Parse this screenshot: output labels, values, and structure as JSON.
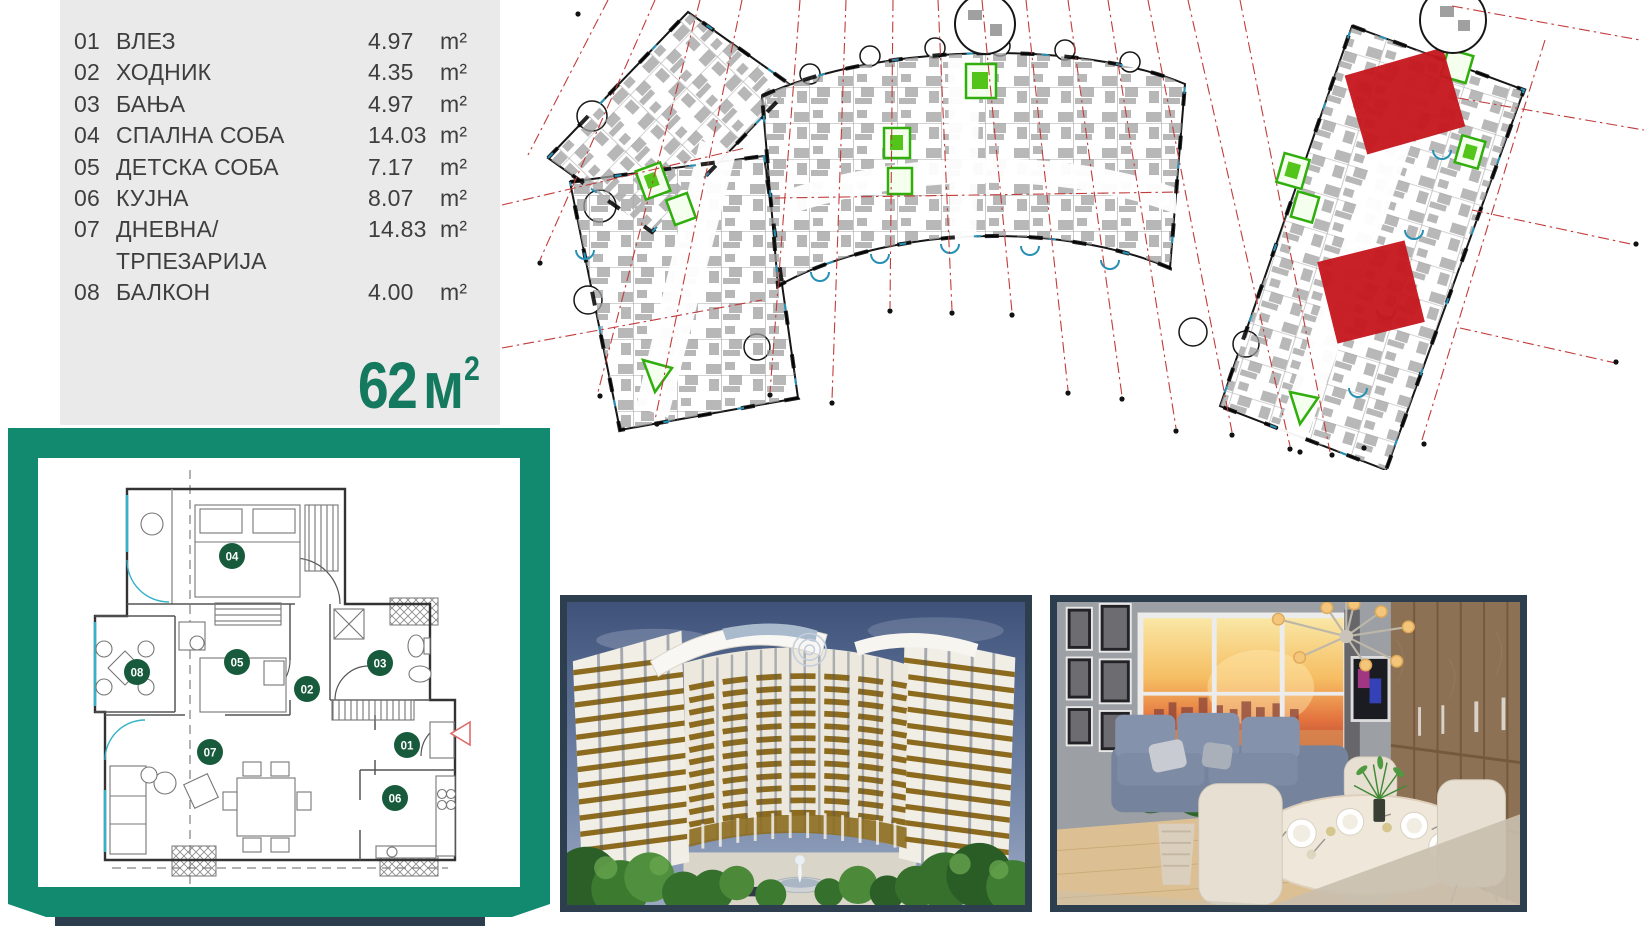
{
  "colors": {
    "panel_gray": "#eaeaea",
    "text_dark": "#3e3e3e",
    "accent_teal_frame": "#118a70",
    "accent_teal_text": "#15795f",
    "navy_frame": "#2d3e4f",
    "marker_green": "#175b3c",
    "highlight_red": "#c6181f",
    "grid_red": "#c23b3b",
    "core_green": "#2fae0c",
    "facade_blue": "#2791b5"
  },
  "room_list": {
    "rows": [
      {
        "no": "01",
        "label": "ВЛЕЗ",
        "area": "4.97",
        "unit": "m²"
      },
      {
        "no": "02",
        "label": "ХОДНИК",
        "area": "4.35",
        "unit": "m²"
      },
      {
        "no": "03",
        "label": "БАЊА",
        "area": "4.97",
        "unit": "m²"
      },
      {
        "no": "04",
        "label": "СПАЛНА СОБА",
        "area": "14.03",
        "unit": "m²"
      },
      {
        "no": "05",
        "label": "ДЕТСКА СОБА",
        "area": "7.17",
        "unit": "m²"
      },
      {
        "no": "06",
        "label": "КУЈНА",
        "area": "8.07",
        "unit": "m²"
      },
      {
        "no": "07",
        "label": "ДНЕВНА/ТРПЕЗАРИЈА",
        "area": "14.83",
        "unit": "m²"
      },
      {
        "no": "08",
        "label": "БАЛКОН",
        "area": "4.00",
        "unit": "m²"
      }
    ]
  },
  "total_area": {
    "value": "62",
    "unit": "м",
    "sup": "2"
  },
  "floor_plan": {
    "markers": [
      "01",
      "02",
      "03",
      "04",
      "05",
      "06",
      "07",
      "08"
    ]
  },
  "site_plan": {
    "highlighted_units": 2,
    "highlight_color": "#c6181f"
  },
  "photos": [
    {
      "name": "building-exterior-render"
    },
    {
      "name": "interior-dining-render"
    }
  ]
}
